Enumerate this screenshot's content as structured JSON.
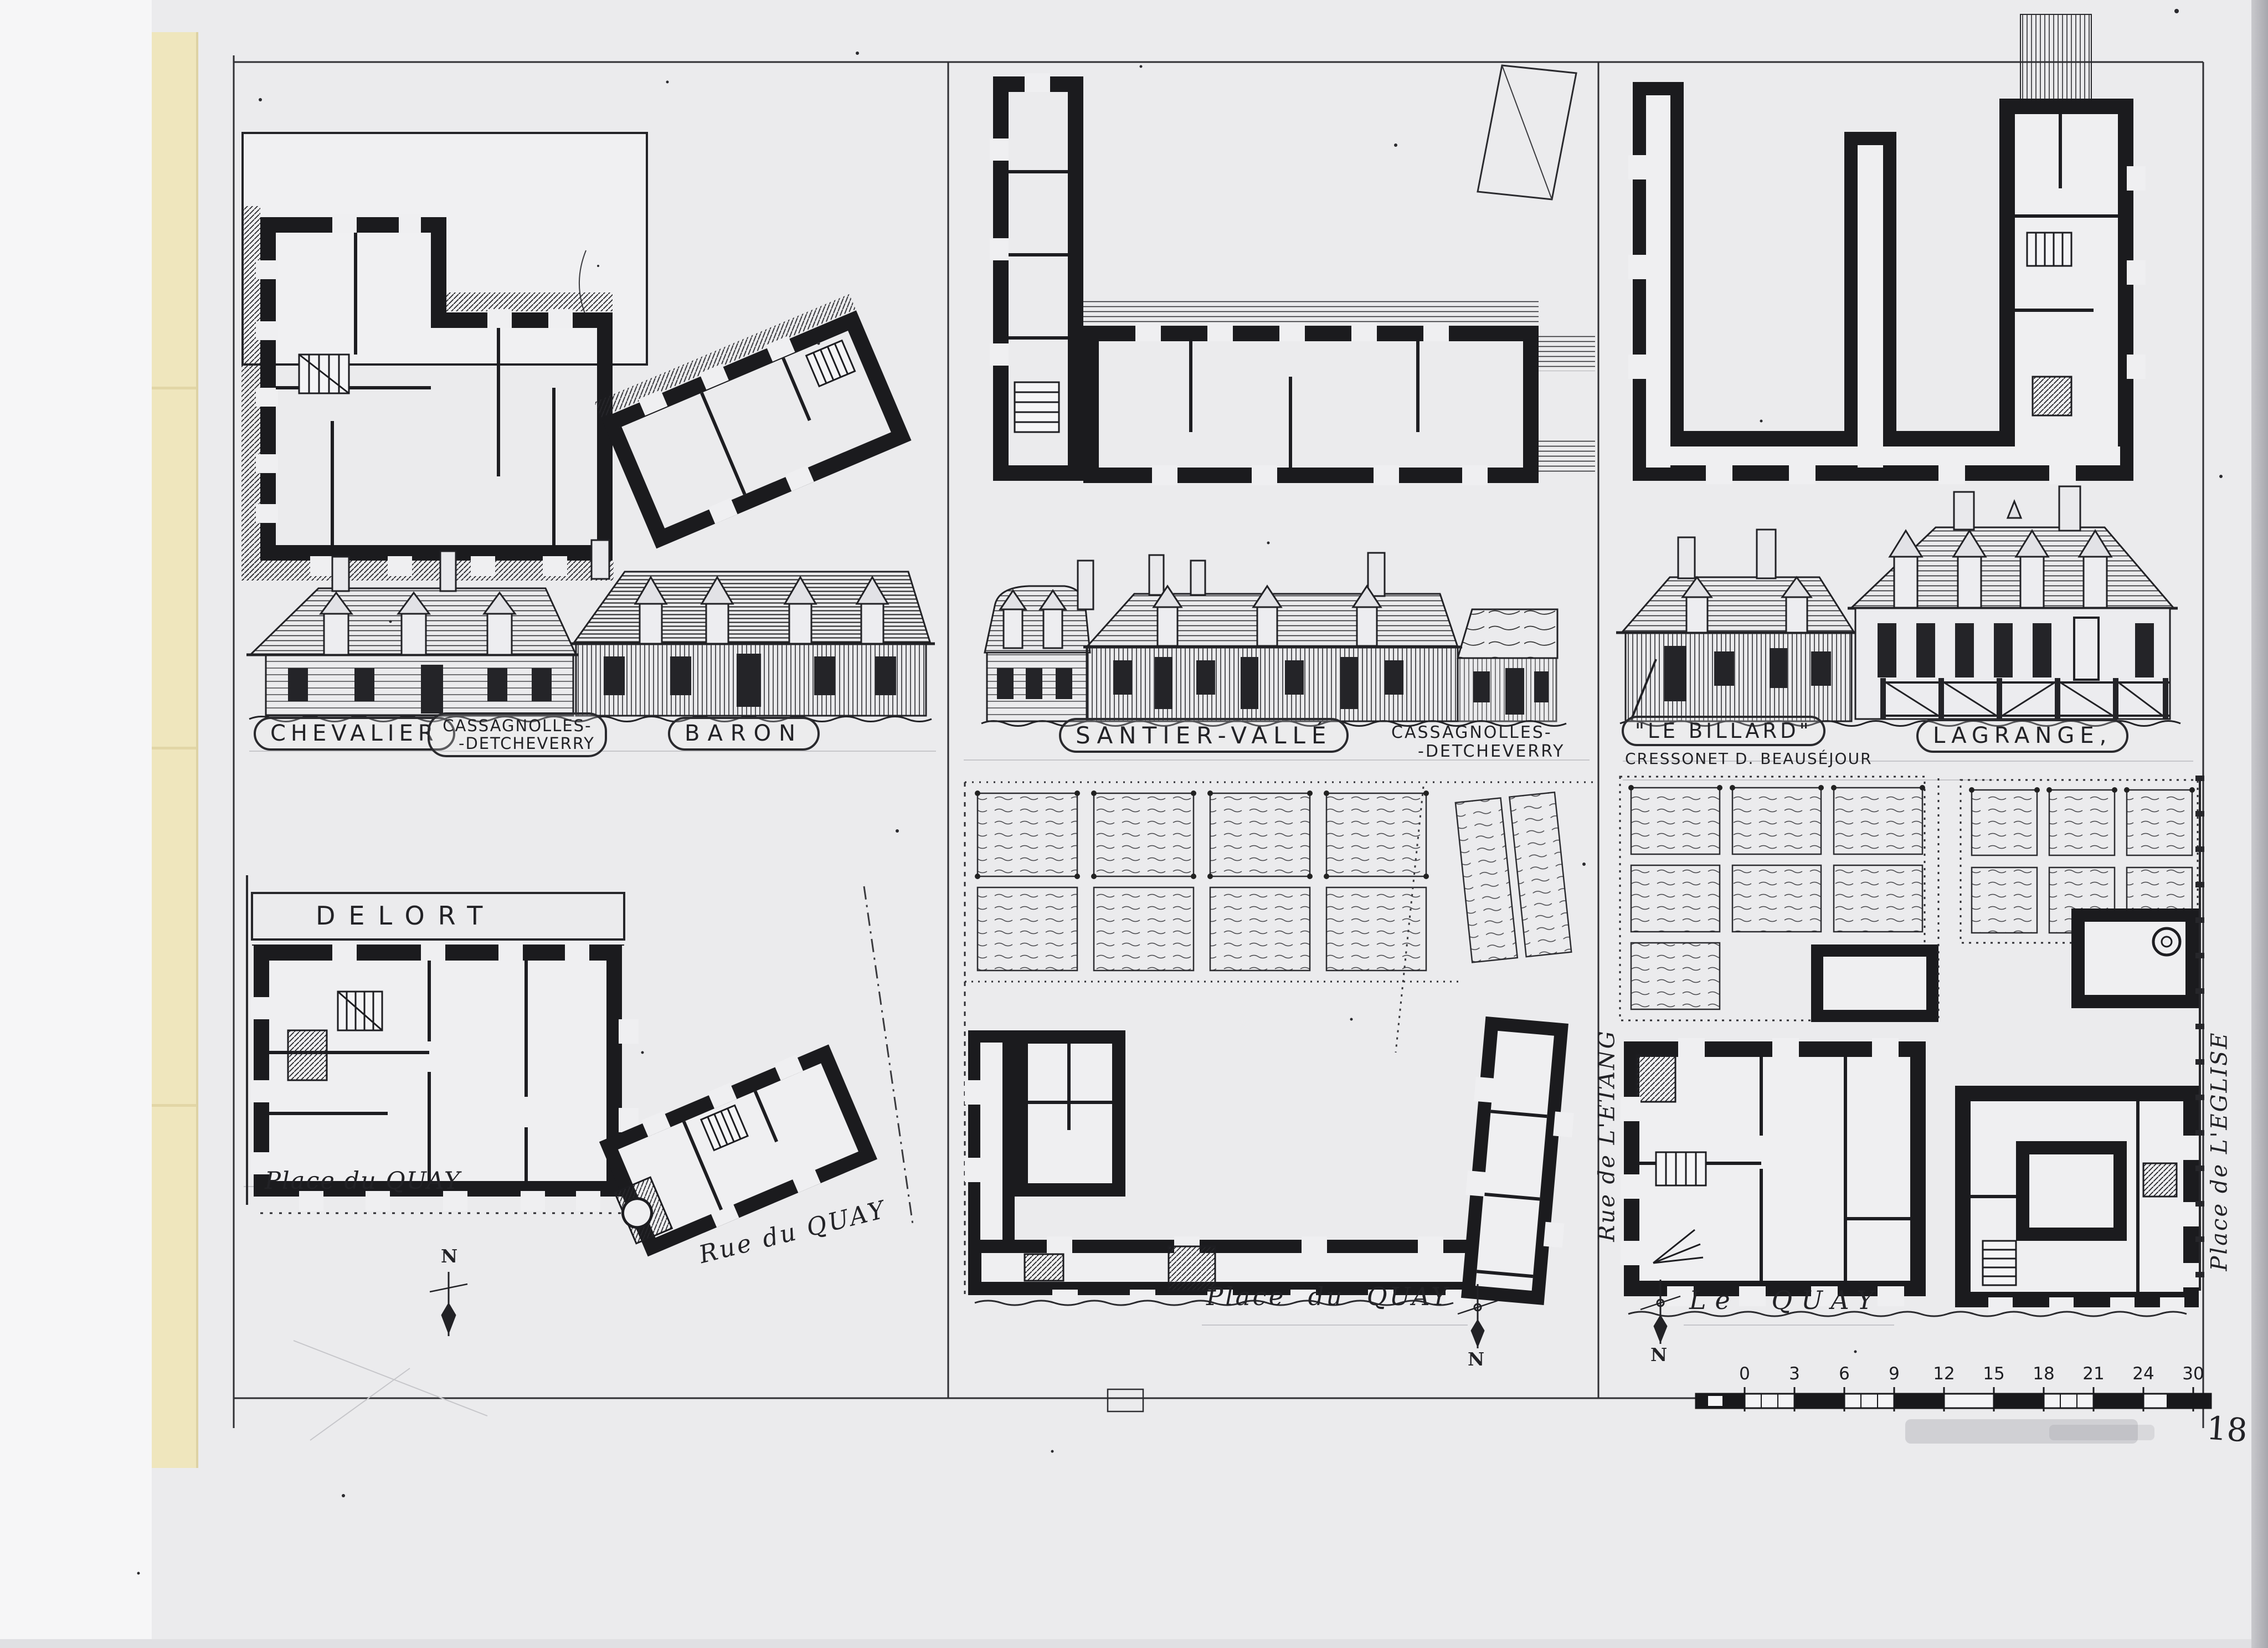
{
  "labels": {
    "chevalier": "CHEVALIER",
    "cassagnolles_detcheverry_left": {
      "line1": "CASSAGNOLLES-",
      "line2": "-DETCHEVERRY"
    },
    "baron": "BARON",
    "santier_valle": "SANTIER-VALLÉ",
    "cassagnolles_detcheverry_mid": {
      "line1": "CASSAGNOLLES-",
      "line2": "-DETCHEVERRY"
    },
    "le_billard": "\"LE BILLARD\"",
    "cressonet": "CRESSONET D. BEAUSÉJOUR",
    "lagrange": "LAGRANGE,",
    "delort": "DELORT",
    "place_du_quay_left": "Place du QUAY",
    "rue_du_quay": "Rue du QUAY",
    "place_du_quay_middle": "Place du  QUAY",
    "le_quay": "Le QUAY",
    "rue_de_letang": "Rue de L'ETANG",
    "place_de_leglise": "Place de L'EGLISE",
    "north": "N"
  },
  "scale_bar": {
    "ticks": [
      "0",
      "3",
      "6",
      "9",
      "12",
      "15",
      "18",
      "21",
      "24",
      "30"
    ]
  },
  "page_number": "18"
}
